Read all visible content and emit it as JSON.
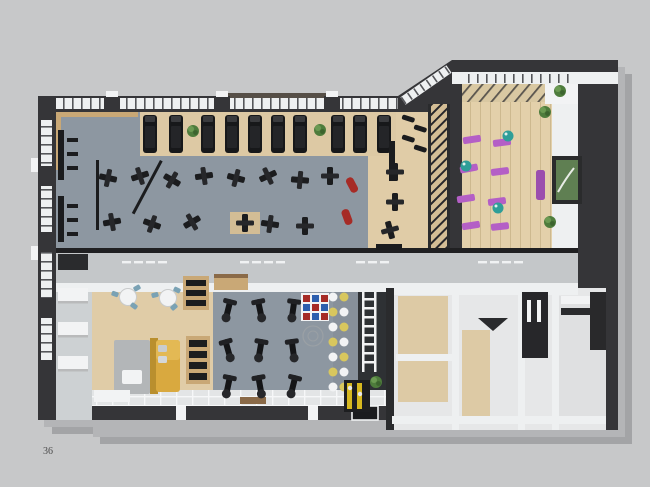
{
  "page": {
    "number": "36"
  },
  "render": {
    "subject": "top-down 3D render of a fitness club floor plan on a gray page",
    "palette": {
      "background": "#c7c8c9",
      "wall_dark": "#353538",
      "wall_white": "#eef0f1",
      "floor_gym_gray": "#8d97a1",
      "floor_wood": "#e0cca7",
      "floor_corridor": "#c4c7c9",
      "equipment_black": "#1b1c1e",
      "mat_purple": "#b45fc6",
      "mat_purple_dark": "#9b4fae",
      "ball_teal": "#2f9e98",
      "sofa_yellow": "#d9a93f",
      "chair_blue": "#7aa2b4",
      "accent_red": "#a62b26",
      "accent_blue": "#2d5fae",
      "dot_yellow": "#d8c75e",
      "plant_green": "#4e7c3c",
      "station_yellow": "#d6b81f"
    },
    "zones": [
      {
        "name": "treadmill-row",
        "equipment": "treadmills",
        "count": 10
      },
      {
        "name": "strength-zone",
        "equipment": "weight machines and benches"
      },
      {
        "name": "free-weights-strip",
        "equipment": "racks and benches on wood floor"
      },
      {
        "name": "yoga-studio",
        "equipment": "purple mats and teal gym balls",
        "mats": 8,
        "balls": 3
      },
      {
        "name": "corridor",
        "equipment": ""
      },
      {
        "name": "lounge",
        "equipment": "yellow sofa, cafe tables with blue chairs, bookshelves"
      },
      {
        "name": "elliptical-zone",
        "equipment": "elliptical trainers",
        "count": 9
      },
      {
        "name": "functional-zone",
        "equipment": "color climbing grid, stepping dots, agility ladder, kettlebell station"
      },
      {
        "name": "locker-rooms",
        "equipment": "changing and utility rooms"
      }
    ]
  }
}
